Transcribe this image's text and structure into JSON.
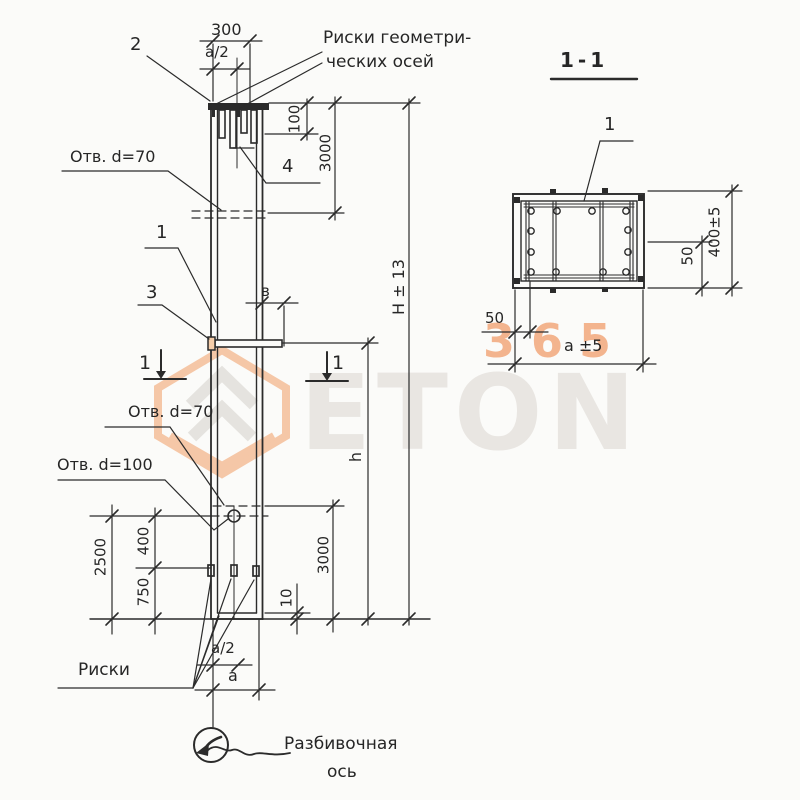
{
  "page": {
    "background": "#fbfbf9",
    "ink": "#262626"
  },
  "watermark": {
    "eton": "ETON",
    "n365": "365",
    "orange": "#f2a87c",
    "grey": "#e9e6e2"
  },
  "view_main": {
    "labels": {
      "mark2": "2",
      "mark1": "1",
      "mark3": "3",
      "mark4": "4",
      "cut_left": "1",
      "cut_right": "1"
    },
    "callouts": {
      "riski_geo1": "Риски геометри-",
      "riski_geo2": "ческих осей",
      "otv70_top": "Отв. d=70",
      "otv70_bot": "Отв. d=70",
      "otv100": "Отв. d=100",
      "riski": "Риски",
      "razbiv1": "Разбивочная",
      "razbiv2": "ось"
    },
    "dims": {
      "d300": "300",
      "a2_top": "а/2",
      "d100": "100",
      "d3000_top": "3000",
      "H": "H ± 13",
      "h": "h",
      "v": "в",
      "d2500": "2500",
      "d400": "400",
      "d750": "750",
      "d10": "10",
      "d3000_bot": "3000",
      "a2_bot": "а/2",
      "a_bot": "а"
    }
  },
  "view_section": {
    "title": "1-1",
    "labels": {
      "mark1": "1"
    },
    "dims": {
      "d400": "400±5",
      "d50_right": "50",
      "d50_left": "50",
      "a5": "а ±5"
    }
  }
}
